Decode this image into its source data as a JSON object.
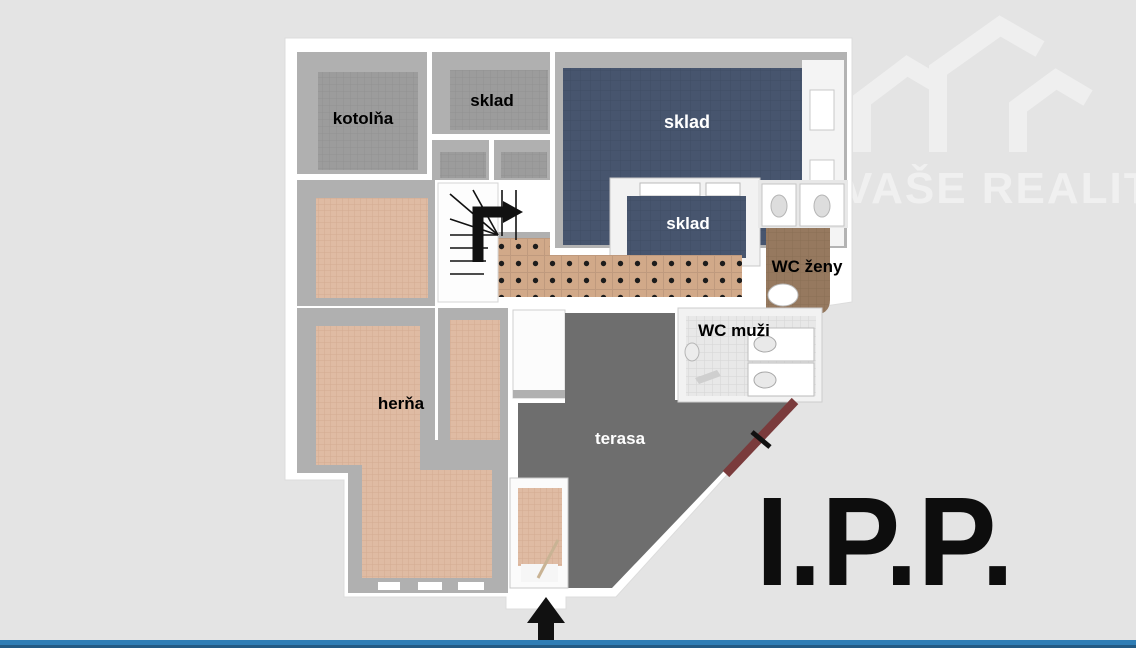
{
  "watermark": {
    "text": "VAŠE REALITY"
  },
  "floor_plan": {
    "labels": {
      "kotolna": "kotolňa",
      "sklad_top": "sklad",
      "sklad_large": "sklad",
      "sklad_small": "sklad",
      "wc_zeny": "WC ženy",
      "wc_muzi": "WC muži",
      "herna": "herňa",
      "terasa": "terasa"
    },
    "floor_label": "I.P.P."
  },
  "colors": {
    "background": "#e4e4e4",
    "plan_base": "#ffffff",
    "wall": "#b0b0b0",
    "floor_gray": "#9c9c9c",
    "floor_blue": "#47556e",
    "floor_salmon": "#dfbba3",
    "floor_corridor_tile": "#d1a989",
    "floor_terrace": "#6e6e6e",
    "floor_wc_zeny": "#96795f",
    "floor_wc_muzi": "#e8e8e8",
    "railing": "#7a3b3c",
    "stairs": "#111111",
    "entrance_arrow": "#111111",
    "floor_label_text": "#0d0d0d",
    "watermark_tint": "#efefef",
    "accent_bar_top": "#2f7db5",
    "accent_bar_bottom": "#235a84"
  }
}
